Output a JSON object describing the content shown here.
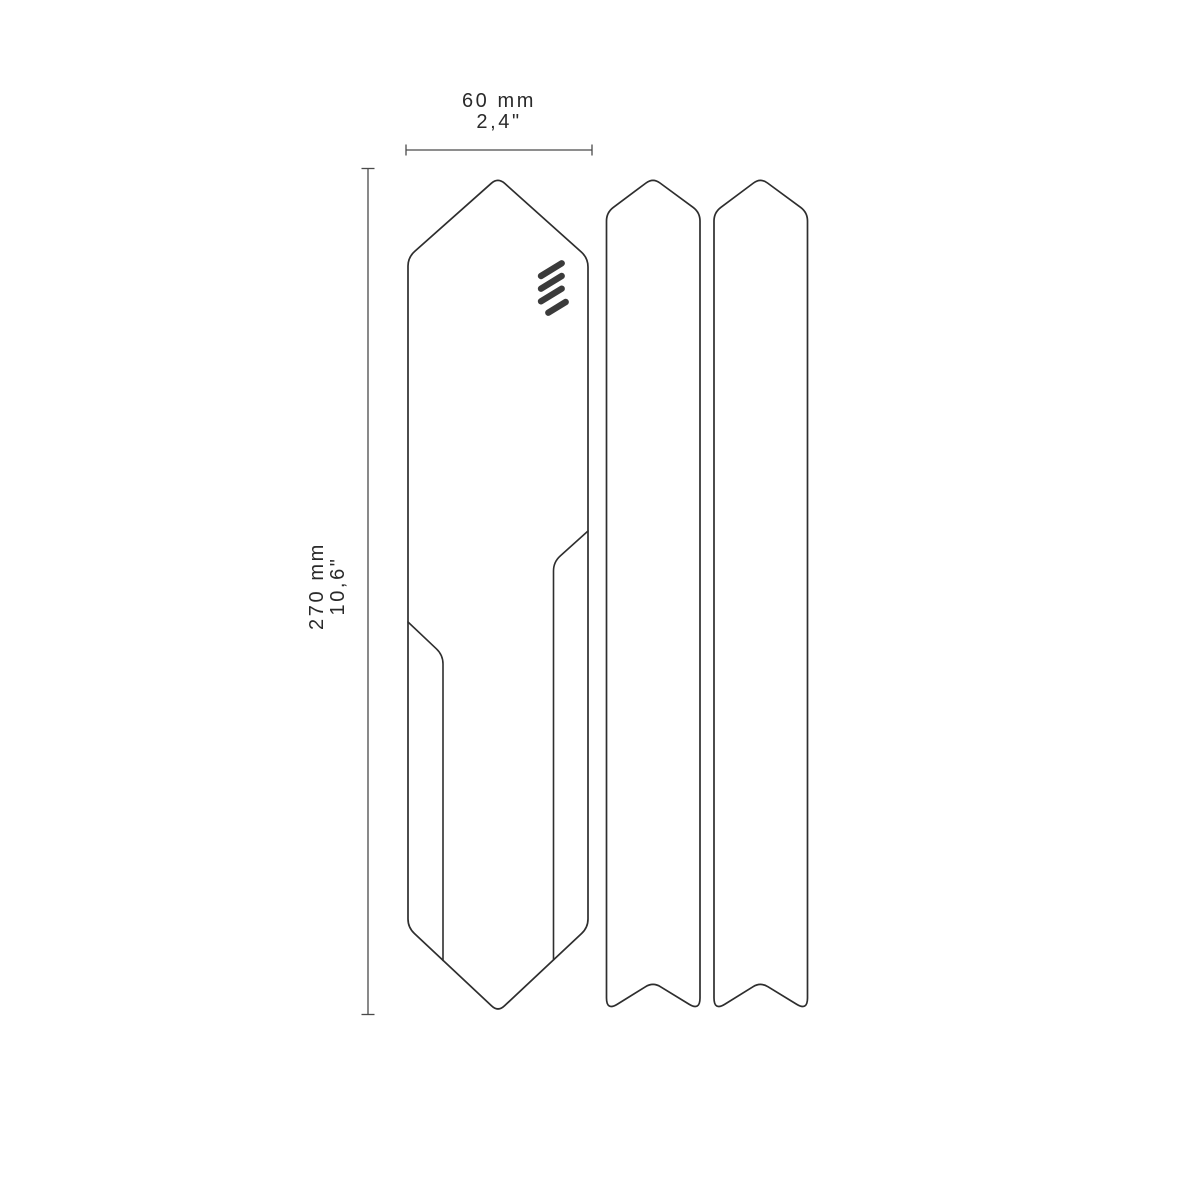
{
  "diagram": {
    "width_dimension": {
      "mm": "60 mm",
      "inch": "2,4\""
    },
    "height_dimension": {
      "mm": "270 mm",
      "inch": "10,6\""
    },
    "pieces": [
      "main-frame-guard",
      "side-strip",
      "side-strip"
    ],
    "logo_icon": "brand-logo-icon"
  },
  "colors": {
    "background": "#ffffff",
    "outline": "#2e2e2e",
    "dimension": "#4a4a4a",
    "text": "#2a2a2a",
    "logo": "#3b3b3b"
  }
}
